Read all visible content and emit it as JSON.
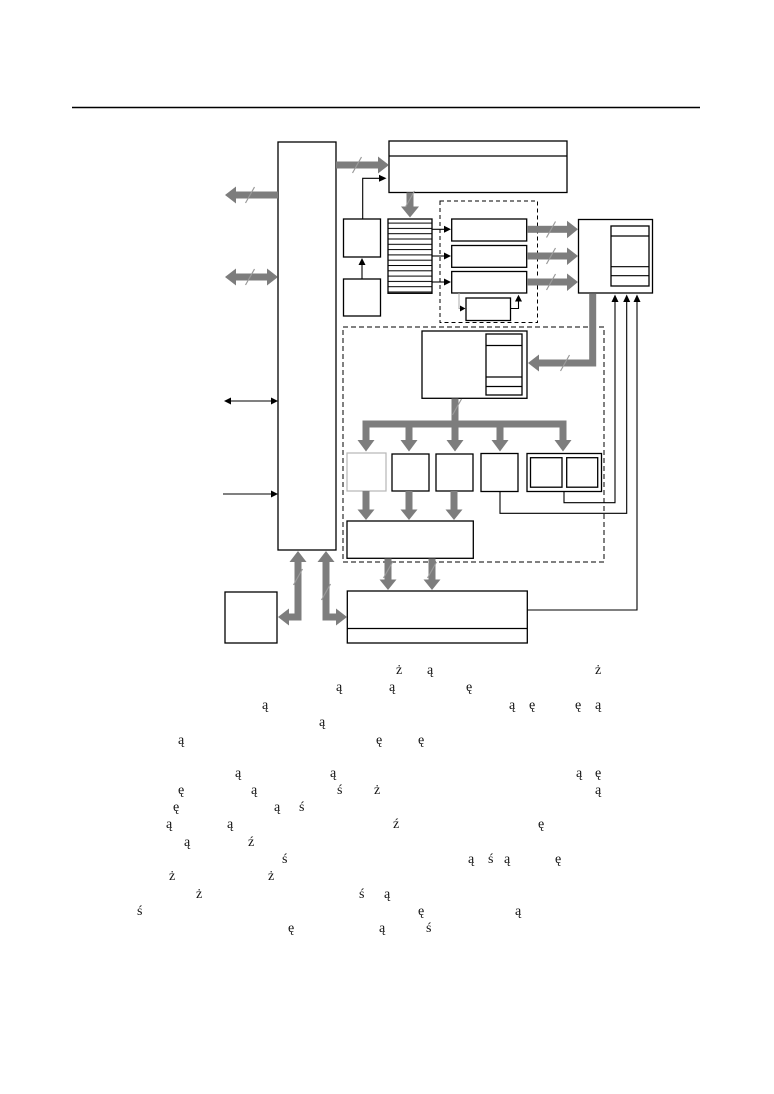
{
  "page": {
    "width": 774,
    "height": 1094,
    "background": "#ffffff"
  },
  "header_rule": {
    "x1": 72,
    "x2": 700,
    "y": 108,
    "color": "#000000"
  },
  "figure": {
    "kind": "block-diagram",
    "line_color": "#000000",
    "bus_arrow_color": "#7d7d7d",
    "slash_tick_color": "#9a9a9a",
    "faded_box_border_color": "#b6b6b6",
    "box_fill": "#ffffff",
    "node_labels_visible": false
  },
  "scattered_text": {
    "font_size": 14,
    "color": "#141414",
    "rows": [
      {
        "y": 664,
        "glyphs": [
          {
            "ch": "ż",
            "x": 396
          },
          {
            "ch": "ą",
            "x": 427
          },
          {
            "ch": "ż",
            "x": 595
          }
        ]
      },
      {
        "y": 681,
        "glyphs": [
          {
            "ch": "ą",
            "x": 336
          },
          {
            "ch": "ą",
            "x": 389
          },
          {
            "ch": "ę",
            "x": 466
          }
        ]
      },
      {
        "y": 699,
        "glyphs": [
          {
            "ch": "ą",
            "x": 262
          },
          {
            "ch": "ą",
            "x": 509
          },
          {
            "ch": "ę",
            "x": 529
          },
          {
            "ch": "ę",
            "x": 575
          },
          {
            "ch": "ą",
            "x": 595
          }
        ]
      },
      {
        "y": 716,
        "glyphs": [
          {
            "ch": "ą",
            "x": 319
          }
        ]
      },
      {
        "y": 734,
        "glyphs": [
          {
            "ch": "ą",
            "x": 178
          },
          {
            "ch": "ę",
            "x": 376
          },
          {
            "ch": "ę",
            "x": 418
          }
        ]
      },
      {
        "y": 767,
        "glyphs": [
          {
            "ch": "ą",
            "x": 235
          },
          {
            "ch": "ą",
            "x": 330
          },
          {
            "ch": "ą",
            "x": 576
          },
          {
            "ch": "ę",
            "x": 595
          }
        ]
      },
      {
        "y": 784,
        "glyphs": [
          {
            "ch": "ę",
            "x": 178
          },
          {
            "ch": "ą",
            "x": 251
          },
          {
            "ch": "ś",
            "x": 337
          },
          {
            "ch": "ż",
            "x": 374
          },
          {
            "ch": "ą",
            "x": 595
          }
        ]
      },
      {
        "y": 801,
        "glyphs": [
          {
            "ch": "ę",
            "x": 173
          },
          {
            "ch": "ą",
            "x": 274
          },
          {
            "ch": "ś",
            "x": 299
          }
        ]
      },
      {
        "y": 818,
        "glyphs": [
          {
            "ch": "ą",
            "x": 166
          },
          {
            "ch": "ą",
            "x": 227
          },
          {
            "ch": "ź",
            "x": 393
          },
          {
            "ch": "ę",
            "x": 538
          }
        ]
      },
      {
        "y": 836,
        "glyphs": [
          {
            "ch": "ą",
            "x": 184
          },
          {
            "ch": "ź",
            "x": 248
          }
        ]
      },
      {
        "y": 853,
        "glyphs": [
          {
            "ch": "ś",
            "x": 282
          },
          {
            "ch": "ą",
            "x": 468
          },
          {
            "ch": "ś",
            "x": 488
          },
          {
            "ch": "ą",
            "x": 504
          },
          {
            "ch": "ę",
            "x": 555
          }
        ]
      },
      {
        "y": 870,
        "glyphs": [
          {
            "ch": "ż",
            "x": 169
          },
          {
            "ch": "ż",
            "x": 268
          }
        ]
      },
      {
        "y": 888,
        "glyphs": [
          {
            "ch": "ż",
            "x": 196
          },
          {
            "ch": "ś",
            "x": 359
          },
          {
            "ch": "ą",
            "x": 384
          }
        ]
      },
      {
        "y": 905,
        "glyphs": [
          {
            "ch": "ś",
            "x": 137
          },
          {
            "ch": "ę",
            "x": 418
          },
          {
            "ch": "ą",
            "x": 515
          }
        ]
      },
      {
        "y": 922,
        "glyphs": [
          {
            "ch": "ę",
            "x": 288
          },
          {
            "ch": "ą",
            "x": 379
          },
          {
            "ch": "ś",
            "x": 426
          }
        ]
      }
    ]
  }
}
